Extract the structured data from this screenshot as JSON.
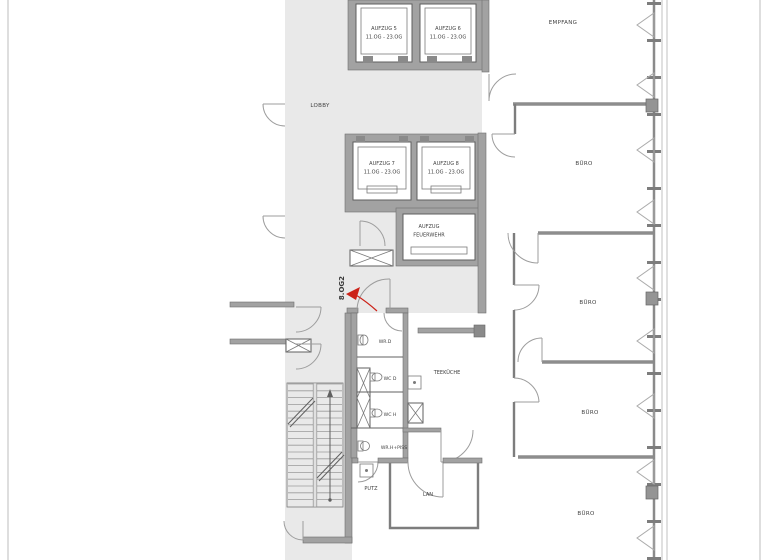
{
  "plan": {
    "marker": {
      "label": "8.OG2",
      "color": "#cc2218"
    },
    "rooms": {
      "lobby": "LOBBY",
      "empfang": "EMPFANG",
      "buero": "BÜRO",
      "teekueche": "TEEKÜCHE",
      "lan": "LAN",
      "putz": "PUTZ",
      "wr_d": "WR.D",
      "wc_d": "WC D",
      "wc_h": "WC H",
      "wr_h_piss": "WR.H+PISS"
    },
    "elevators": {
      "a5": {
        "name": "AUFZUG 5",
        "range": "11.OG - 23.OG"
      },
      "a6": {
        "name": "AUFZUG 6",
        "range": "11.OG - 23.OG"
      },
      "a7": {
        "name": "AUFZUG 7",
        "range": "11.OG - 23.OG"
      },
      "a8": {
        "name": "AUFZUG 8",
        "range": "11.OG - 23.OG"
      },
      "fire": {
        "line1": "AUFZUG",
        "line2": "FEUERWEHR"
      }
    },
    "colors": {
      "core_background": "#e9e9e9",
      "wall": "#a2a2a2",
      "line": "#606060",
      "accent_red": "#cc2218"
    }
  }
}
